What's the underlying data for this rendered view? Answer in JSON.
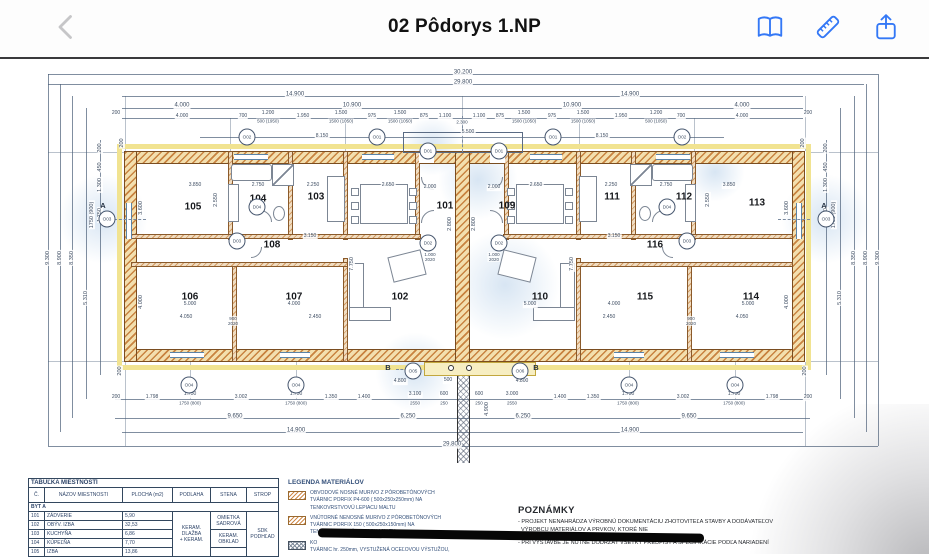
{
  "toolbar": {
    "title": "02 Pôdorys 1.NP",
    "accent_color": "#3478F6",
    "back_color": "#c6c6c8",
    "icons": [
      "back-icon",
      "book-icon",
      "ruler-icon",
      "share-icon"
    ]
  },
  "room_table": {
    "title": "TABUĽKA MIESTNOSTÍ",
    "headers": [
      "Č.",
      "NÁZOV MIESTNOSTI",
      "PLOCHA (m2)",
      "PODLAHA",
      "STENA",
      "STROP"
    ],
    "section": "BYT A",
    "rows": [
      {
        "no": "101",
        "name": "ZÁDVERIE",
        "area": "5,90"
      },
      {
        "no": "102",
        "name": "OBÝV. IZBA",
        "area": "32,53"
      },
      {
        "no": "103",
        "name": "KUCHYŇA",
        "area": "6,86"
      },
      {
        "no": "104",
        "name": "KÚPEĽŇA",
        "area": "7,70"
      },
      {
        "no": "105",
        "name": "IZBA",
        "area": "13,86"
      }
    ],
    "podlaha": "KERAM.\nDLAŽBA\n+ KERAM.",
    "stena1": "OMIETKA\nSADROVÁ",
    "stena2": "KERAM.\nOBKLAD",
    "strop": "SDK\nPODHĽAD"
  },
  "legend": {
    "title": "LEGENDA MATERIÁLOV",
    "items": [
      {
        "text": "OBVODOVÉ NOSNÉ MURIVO Z PÓROBETÓNOVÝCH\nTVÁRNIC PORFIX P4-600 ( 500x250x250mm) NA\nTENKOVRSTVOVÚ LEPIACU MALTU"
      },
      {
        "text": "VNÚTORNÉ NENOSNÉ MURIVO Z PÓROBETÓNOVÝCH\nTVÁRNIC PORFIX 150 ( 500x250x150mm) NA\nTENKOVRSTVOVÚ LEPIACU MALTU"
      },
      {
        "text": "KO\nTVÁRNIC hr. 250mm, VYSTUŽENÁ OCEĽOVOU VÝSTUŽOU,"
      }
    ]
  },
  "notes": {
    "title": "POZNÁMKY",
    "lines": [
      "- PROJEKT NENAHRÁDZA VÝROBNÚ DOKUMENTÁCIU ZHOTOVITEĽA STAVBY A DODÁVATEĽOV",
      "- PRI VÝSTAVBE JE NUTNÉ DODRŽAŤ VŠETKY PREDPISY A ŠPECIFIKÁCIE PODĽA NARIADENÍ",
      "VÝROBCU MATERIÁLOV A PRVKOV, KTORÉ NIE"
    ]
  },
  "plan": {
    "labels": [
      {
        "t": "30.200",
        "x": 463,
        "y": 73,
        "c": "d"
      },
      {
        "t": "29.800",
        "x": 463,
        "y": 83,
        "c": "d"
      },
      {
        "t": "14.900",
        "x": 295,
        "y": 95,
        "c": "d"
      },
      {
        "t": "14.900",
        "x": 630,
        "y": 95,
        "c": "d"
      },
      {
        "t": "4.000",
        "x": 182,
        "y": 106,
        "c": "d"
      },
      {
        "t": "10.900",
        "x": 352,
        "y": 106,
        "c": "d"
      },
      {
        "t": "10.900",
        "x": 572,
        "y": 106,
        "c": "d"
      },
      {
        "t": "4.000",
        "x": 742,
        "y": 106,
        "c": "d"
      },
      {
        "t": "200",
        "x": 116,
        "y": 114,
        "c": "s"
      },
      {
        "t": "4.000",
        "x": 182,
        "y": 117,
        "c": "s"
      },
      {
        "t": "700",
        "x": 243,
        "y": 117,
        "c": "s"
      },
      {
        "t": "1.200",
        "x": 268,
        "y": 114,
        "c": "s"
      },
      {
        "t": "500 (1950)",
        "x": 268,
        "y": 121,
        "c": "u"
      },
      {
        "t": "1.950",
        "x": 303,
        "y": 117,
        "c": "s"
      },
      {
        "t": "1.500",
        "x": 341,
        "y": 114,
        "c": "s"
      },
      {
        "t": "1500 (1050)",
        "x": 341,
        "y": 121,
        "c": "u"
      },
      {
        "t": "975",
        "x": 372,
        "y": 117,
        "c": "s"
      },
      {
        "t": "1.500",
        "x": 400,
        "y": 114,
        "c": "s"
      },
      {
        "t": "1500 (1050)",
        "x": 400,
        "y": 121,
        "c": "u"
      },
      {
        "t": "875",
        "x": 424,
        "y": 117,
        "c": "s"
      },
      {
        "t": "1.100",
        "x": 445,
        "y": 117,
        "c": "s"
      },
      {
        "t": "2.300",
        "x": 462,
        "y": 122,
        "c": "u"
      },
      {
        "t": "1.100",
        "x": 479,
        "y": 117,
        "c": "s"
      },
      {
        "t": "875",
        "x": 500,
        "y": 117,
        "c": "s"
      },
      {
        "t": "1.500",
        "x": 524,
        "y": 114,
        "c": "s"
      },
      {
        "t": "1500 (1050)",
        "x": 524,
        "y": 121,
        "c": "u"
      },
      {
        "t": "975",
        "x": 552,
        "y": 117,
        "c": "s"
      },
      {
        "t": "1.500",
        "x": 583,
        "y": 114,
        "c": "s"
      },
      {
        "t": "1500 (1050)",
        "x": 583,
        "y": 121,
        "c": "u"
      },
      {
        "t": "1.950",
        "x": 621,
        "y": 117,
        "c": "s"
      },
      {
        "t": "1.200",
        "x": 656,
        "y": 114,
        "c": "s"
      },
      {
        "t": "500 (1050)",
        "x": 656,
        "y": 121,
        "c": "u"
      },
      {
        "t": "700",
        "x": 681,
        "y": 117,
        "c": "s"
      },
      {
        "t": "4.000",
        "x": 742,
        "y": 117,
        "c": "s"
      },
      {
        "t": "200",
        "x": 808,
        "y": 114,
        "c": "s"
      },
      {
        "t": "8.150",
        "x": 322,
        "y": 137,
        "c": "s"
      },
      {
        "t": "5.500",
        "x": 468,
        "y": 133,
        "c": "s"
      },
      {
        "t": "8.150",
        "x": 602,
        "y": 137,
        "c": "s"
      },
      {
        "t": "9.300",
        "x": 48,
        "y": 258,
        "c": "v"
      },
      {
        "t": "8.900",
        "x": 60,
        "y": 258,
        "c": "v"
      },
      {
        "t": "8.350",
        "x": 72,
        "y": 258,
        "c": "v"
      },
      {
        "t": "5.310",
        "x": 86,
        "y": 298,
        "c": "v"
      },
      {
        "t": "200",
        "x": 100,
        "y": 148,
        "c": "v"
      },
      {
        "t": "450",
        "x": 100,
        "y": 167,
        "c": "v"
      },
      {
        "t": "1.300",
        "x": 100,
        "y": 185,
        "c": "v"
      },
      {
        "t": "1.750",
        "x": 100,
        "y": 215,
        "c": "v"
      },
      {
        "t": "1750 (900)",
        "x": 92,
        "y": 215,
        "c": "v"
      },
      {
        "t": "9.300",
        "x": 878,
        "y": 258,
        "c": "v"
      },
      {
        "t": "8.900",
        "x": 866,
        "y": 258,
        "c": "v"
      },
      {
        "t": "8.350",
        "x": 854,
        "y": 258,
        "c": "v"
      },
      {
        "t": "5.310",
        "x": 840,
        "y": 298,
        "c": "v"
      },
      {
        "t": "200",
        "x": 826,
        "y": 148,
        "c": "v"
      },
      {
        "t": "450",
        "x": 826,
        "y": 167,
        "c": "v"
      },
      {
        "t": "1.300",
        "x": 826,
        "y": 185,
        "c": "v"
      },
      {
        "t": "1.750",
        "x": 826,
        "y": 215,
        "c": "v"
      },
      {
        "t": "1750 (900)",
        "x": 834,
        "y": 215,
        "c": "v"
      },
      {
        "t": "200",
        "x": 122,
        "y": 143,
        "c": "v"
      },
      {
        "t": "200",
        "x": 803,
        "y": 143,
        "c": "v"
      },
      {
        "t": "200",
        "x": 120,
        "y": 371,
        "c": "v"
      },
      {
        "t": "200",
        "x": 805,
        "y": 371,
        "c": "v"
      },
      {
        "t": "200",
        "x": 116,
        "y": 398,
        "c": "s"
      },
      {
        "t": "1.798",
        "x": 152,
        "y": 398,
        "c": "s"
      },
      {
        "t": "1.750",
        "x": 190,
        "y": 395,
        "c": "s"
      },
      {
        "t": "1750 (800)",
        "x": 190,
        "y": 403,
        "c": "u"
      },
      {
        "t": "3.002",
        "x": 241,
        "y": 398,
        "c": "s"
      },
      {
        "t": "1.750",
        "x": 296,
        "y": 395,
        "c": "s"
      },
      {
        "t": "1750 (800)",
        "x": 296,
        "y": 403,
        "c": "u"
      },
      {
        "t": "1.350",
        "x": 331,
        "y": 398,
        "c": "s"
      },
      {
        "t": "1.400",
        "x": 364,
        "y": 398,
        "c": "s"
      },
      {
        "t": "3.100",
        "x": 415,
        "y": 395,
        "c": "s"
      },
      {
        "t": "2550",
        "x": 415,
        "y": 403,
        "c": "u"
      },
      {
        "t": "600",
        "x": 444,
        "y": 395,
        "c": "s"
      },
      {
        "t": "250",
        "x": 444,
        "y": 403,
        "c": "u"
      },
      {
        "t": "600",
        "x": 479,
        "y": 395,
        "c": "s"
      },
      {
        "t": "250",
        "x": 479,
        "y": 403,
        "c": "u"
      },
      {
        "t": "3.000",
        "x": 512,
        "y": 395,
        "c": "s"
      },
      {
        "t": "2550",
        "x": 512,
        "y": 403,
        "c": "u"
      },
      {
        "t": "1.400",
        "x": 560,
        "y": 398,
        "c": "s"
      },
      {
        "t": "1.350",
        "x": 593,
        "y": 398,
        "c": "s"
      },
      {
        "t": "1.750",
        "x": 628,
        "y": 395,
        "c": "s"
      },
      {
        "t": "1750 (800)",
        "x": 628,
        "y": 403,
        "c": "u"
      },
      {
        "t": "3.002",
        "x": 683,
        "y": 398,
        "c": "s"
      },
      {
        "t": "1.750",
        "x": 734,
        "y": 395,
        "c": "s"
      },
      {
        "t": "1750 (800)",
        "x": 734,
        "y": 403,
        "c": "u"
      },
      {
        "t": "1.798",
        "x": 772,
        "y": 398,
        "c": "s"
      },
      {
        "t": "200",
        "x": 808,
        "y": 398,
        "c": "s"
      },
      {
        "t": "4.800",
        "x": 400,
        "y": 382,
        "c": "s"
      },
      {
        "t": "500",
        "x": 448,
        "y": 381,
        "c": "s"
      },
      {
        "t": "4.800",
        "x": 522,
        "y": 382,
        "c": "s"
      },
      {
        "t": "4.900",
        "x": 487,
        "y": 409,
        "c": "v"
      },
      {
        "t": "9.650",
        "x": 235,
        "y": 417,
        "c": "d"
      },
      {
        "t": "6.250",
        "x": 408,
        "y": 417,
        "c": "d"
      },
      {
        "t": "6.250",
        "x": 523,
        "y": 417,
        "c": "d"
      },
      {
        "t": "9.650",
        "x": 689,
        "y": 417,
        "c": "d"
      },
      {
        "t": "14.900",
        "x": 296,
        "y": 431,
        "c": "d"
      },
      {
        "t": "14.900",
        "x": 630,
        "y": 431,
        "c": "d"
      },
      {
        "t": "29.800",
        "x": 452,
        "y": 445,
        "c": "d"
      },
      {
        "t": "105",
        "x": 193,
        "y": 207,
        "c": "r"
      },
      {
        "t": "104",
        "x": 258,
        "y": 199,
        "c": "r"
      },
      {
        "t": "103",
        "x": 316,
        "y": 197,
        "c": "r"
      },
      {
        "t": "101",
        "x": 445,
        "y": 206,
        "c": "r"
      },
      {
        "t": "109",
        "x": 507,
        "y": 206,
        "c": "r"
      },
      {
        "t": "111",
        "x": 612,
        "y": 197,
        "c": "r"
      },
      {
        "t": "112",
        "x": 684,
        "y": 197,
        "c": "r"
      },
      {
        "t": "113",
        "x": 757,
        "y": 203,
        "c": "r"
      },
      {
        "t": "108",
        "x": 272,
        "y": 245,
        "c": "r"
      },
      {
        "t": "116",
        "x": 655,
        "y": 245,
        "c": "r"
      },
      {
        "t": "106",
        "x": 190,
        "y": 297,
        "c": "r"
      },
      {
        "t": "107",
        "x": 294,
        "y": 297,
        "c": "r"
      },
      {
        "t": "102",
        "x": 400,
        "y": 297,
        "c": "r"
      },
      {
        "t": "110",
        "x": 540,
        "y": 297,
        "c": "r"
      },
      {
        "t": "115",
        "x": 645,
        "y": 297,
        "c": "r"
      },
      {
        "t": "114",
        "x": 751,
        "y": 297,
        "c": "r"
      },
      {
        "t": "3.850",
        "x": 195,
        "y": 186,
        "c": "s"
      },
      {
        "t": "2.750",
        "x": 258,
        "y": 186,
        "c": "s"
      },
      {
        "t": "2.250",
        "x": 313,
        "y": 186,
        "c": "s"
      },
      {
        "t": "2.650",
        "x": 388,
        "y": 186,
        "c": "s"
      },
      {
        "t": "2.000",
        "x": 430,
        "y": 188,
        "c": "s"
      },
      {
        "t": "2.000",
        "x": 494,
        "y": 188,
        "c": "s"
      },
      {
        "t": "2.650",
        "x": 536,
        "y": 186,
        "c": "s"
      },
      {
        "t": "2.250",
        "x": 611,
        "y": 186,
        "c": "s"
      },
      {
        "t": "2.750",
        "x": 666,
        "y": 186,
        "c": "s"
      },
      {
        "t": "3.850",
        "x": 729,
        "y": 186,
        "c": "s"
      },
      {
        "t": "5.000",
        "x": 190,
        "y": 305,
        "c": "s"
      },
      {
        "t": "4.050",
        "x": 186,
        "y": 318,
        "c": "s"
      },
      {
        "t": "4.000",
        "x": 294,
        "y": 305,
        "c": "s"
      },
      {
        "t": "2.450",
        "x": 315,
        "y": 318,
        "c": "s"
      },
      {
        "t": "5.000",
        "x": 530,
        "y": 305,
        "c": "s"
      },
      {
        "t": "4.000",
        "x": 614,
        "y": 305,
        "c": "s"
      },
      {
        "t": "2.450",
        "x": 609,
        "y": 318,
        "c": "s"
      },
      {
        "t": "5.000",
        "x": 748,
        "y": 305,
        "c": "s"
      },
      {
        "t": "4.050",
        "x": 742,
        "y": 318,
        "c": "s"
      },
      {
        "t": "3.150",
        "x": 310,
        "y": 237,
        "c": "s"
      },
      {
        "t": "3.150",
        "x": 614,
        "y": 237,
        "c": "s"
      },
      {
        "t": "900\n2020",
        "x": 233,
        "y": 321,
        "c": "u"
      },
      {
        "t": "900\n2020",
        "x": 691,
        "y": 321,
        "c": "u"
      },
      {
        "t": "1.000\n2020",
        "x": 430,
        "y": 257,
        "c": "u"
      },
      {
        "t": "1.000\n2020",
        "x": 494,
        "y": 257,
        "c": "u"
      },
      {
        "t": "3.600",
        "x": 141,
        "y": 208,
        "c": "v"
      },
      {
        "t": "4.000",
        "x": 141,
        "y": 302,
        "c": "v"
      },
      {
        "t": "3.600",
        "x": 787,
        "y": 208,
        "c": "v"
      },
      {
        "t": "4.000",
        "x": 787,
        "y": 302,
        "c": "v"
      },
      {
        "t": "7.750",
        "x": 352,
        "y": 264,
        "c": "v"
      },
      {
        "t": "7.750",
        "x": 572,
        "y": 264,
        "c": "v"
      },
      {
        "t": "2.800",
        "x": 450,
        "y": 224,
        "c": "v"
      },
      {
        "t": "2.800",
        "x": 474,
        "y": 224,
        "c": "v"
      },
      {
        "t": "2.550",
        "x": 216,
        "y": 200,
        "c": "v"
      },
      {
        "t": "2.550",
        "x": 708,
        "y": 200,
        "c": "v"
      },
      {
        "t": "O02",
        "x": 247,
        "y": 137,
        "c": "o"
      },
      {
        "t": "O01",
        "x": 377,
        "y": 137,
        "c": "o"
      },
      {
        "t": "O01",
        "x": 553,
        "y": 137,
        "c": "o"
      },
      {
        "t": "O02",
        "x": 682,
        "y": 137,
        "c": "o"
      },
      {
        "t": "D01",
        "x": 428,
        "y": 151,
        "c": "o"
      },
      {
        "t": "D01",
        "x": 499,
        "y": 151,
        "c": "o"
      },
      {
        "t": "D02",
        "x": 428,
        "y": 243,
        "c": "o"
      },
      {
        "t": "D02",
        "x": 499,
        "y": 243,
        "c": "o"
      },
      {
        "t": "D04",
        "x": 257,
        "y": 207,
        "c": "o"
      },
      {
        "t": "D04",
        "x": 667,
        "y": 207,
        "c": "o"
      },
      {
        "t": "D03",
        "x": 237,
        "y": 241,
        "c": "o"
      },
      {
        "t": "D03",
        "x": 687,
        "y": 241,
        "c": "o"
      },
      {
        "t": "O03",
        "x": 107,
        "y": 219,
        "c": "o"
      },
      {
        "t": "O03",
        "x": 826,
        "y": 219,
        "c": "o"
      },
      {
        "t": "O04",
        "x": 189,
        "y": 385,
        "c": "o"
      },
      {
        "t": "O04",
        "x": 296,
        "y": 385,
        "c": "o"
      },
      {
        "t": "O05",
        "x": 413,
        "y": 371,
        "c": "o"
      },
      {
        "t": "O06",
        "x": 520,
        "y": 371,
        "c": "o"
      },
      {
        "t": "O04",
        "x": 629,
        "y": 385,
        "c": "o"
      },
      {
        "t": "O04",
        "x": 735,
        "y": 385,
        "c": "o"
      },
      {
        "t": "A",
        "x": 103,
        "y": 206,
        "c": "m"
      },
      {
        "t": "A",
        "x": 824,
        "y": 206,
        "c": "m"
      },
      {
        "t": "B",
        "x": 388,
        "y": 368,
        "c": "m"
      },
      {
        "t": "B",
        "x": 536,
        "y": 368,
        "c": "m"
      }
    ]
  }
}
